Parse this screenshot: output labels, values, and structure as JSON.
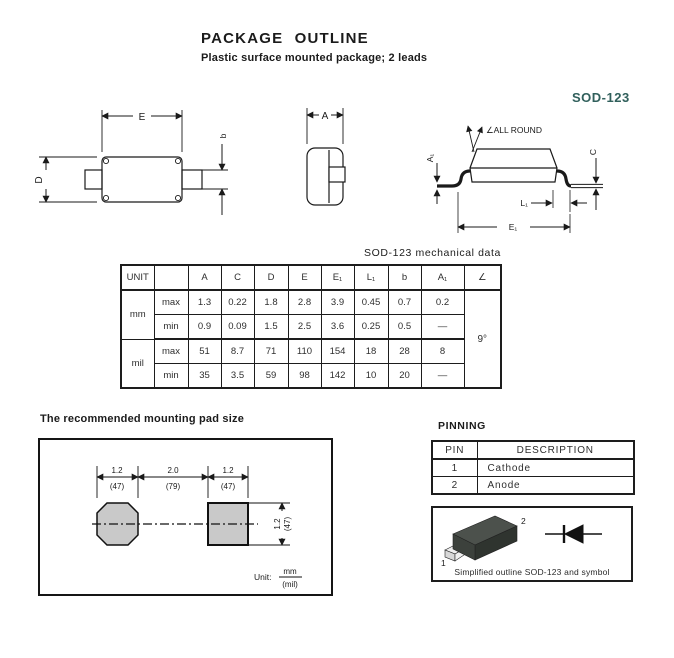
{
  "page": {
    "title": "PACKAGE OUTLINE",
    "subtitle": "Plastic surface mounted package; 2 leads",
    "package_name": "SOD-123",
    "accent_color": "#31605c",
    "ink_color": "#1a1a1a"
  },
  "drawings": {
    "top_view": {
      "dim_e": "E",
      "dim_d": "D",
      "dim_b": "b"
    },
    "end_view": {
      "dim_a": "A"
    },
    "side_view": {
      "note": "∠ALL ROUND",
      "dim_a1": "A₁",
      "dim_c": "C",
      "dim_l1": "L₁",
      "dim_e1": "E₁"
    }
  },
  "mech_table": {
    "caption": "SOD-123 mechanical data",
    "columns": [
      "UNIT",
      "",
      "A",
      "C",
      "D",
      "E",
      "E₁",
      "L₁",
      "b",
      "A₁",
      "∠"
    ],
    "labels": {
      "max": "max",
      "min": "min"
    },
    "unit_mm": "mm",
    "unit_mil": "mil",
    "angle": "9°",
    "mm_max": [
      "1.3",
      "0.22",
      "1.8",
      "2.8",
      "3.9",
      "0.45",
      "0.7",
      "0.2"
    ],
    "mm_min": [
      "0.9",
      "0.09",
      "1.5",
      "2.5",
      "3.6",
      "0.25",
      "0.5",
      "—"
    ],
    "mil_max": [
      "51",
      "8.7",
      "71",
      "110",
      "154",
      "18",
      "28",
      "8"
    ],
    "mil_min": [
      "35",
      "3.5",
      "59",
      "98",
      "142",
      "10",
      "20",
      "—"
    ]
  },
  "mounting_pad": {
    "heading": "The recommended mounting pad size",
    "pad_color": "#c9c9c9",
    "dims": {
      "left_mm": "1.2",
      "left_mil": "(47)",
      "center_mm": "2.0",
      "center_mil": "(79)",
      "right_mm": "1.2",
      "right_mil": "(47)",
      "height_mm": "1.2",
      "height_mil": "(47)"
    },
    "unit": {
      "label": "Unit:",
      "num": "mm",
      "den": "(mil)"
    }
  },
  "pinning": {
    "heading": "PINNING",
    "columns": [
      "PIN",
      "DESCRIPTION"
    ],
    "rows": [
      [
        "1",
        "Cathode"
      ],
      [
        "2",
        "Anode"
      ]
    ],
    "pin_labels": {
      "p1": "1",
      "p2": "2"
    },
    "package_colors": {
      "top": "#4c514c",
      "front": "#2f342f",
      "side": "#3c413c",
      "lead": "#efefef",
      "lead_side": "#d8d8d8"
    },
    "outline_caption": "Simplified outline SOD-123 and symbol"
  }
}
